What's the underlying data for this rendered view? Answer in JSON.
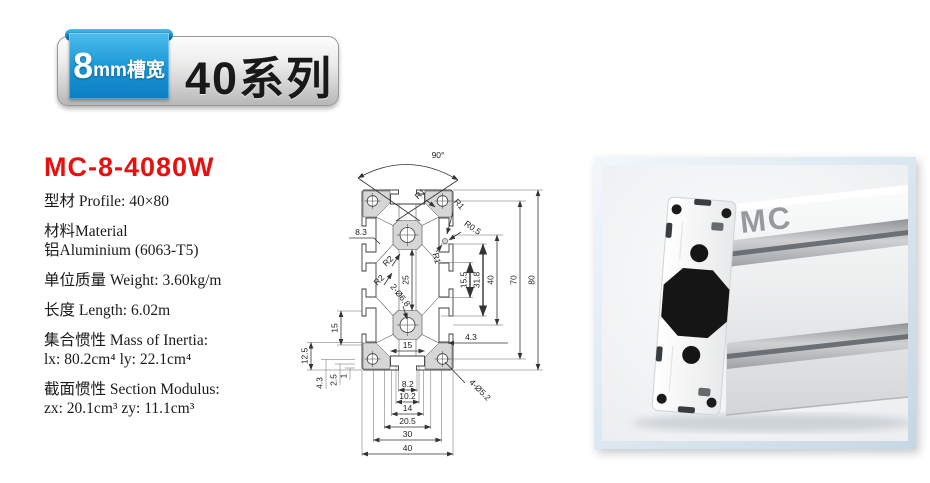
{
  "badge": {
    "slot_number": "8",
    "slot_unit": "mm槽宽",
    "series": "40系列",
    "ribbon_color": "#1b96d5"
  },
  "product": {
    "model": "MC-8-4080W",
    "accent_color": "#e8100e",
    "specs": [
      "型材 Profile: 40×80",
      "材料Material",
      "铝Aluminium (6063-T5)",
      "单位质量 Weight: 3.60kg/m",
      "长度 Length: 6.02m",
      "集合惯性 Mass of Inertia:",
      "lx: 80.2cm⁴   ly: 22.1cm⁴",
      "截面惯性 Section Modulus:",
      "zx: 20.1cm³  zy: 11.1cm³"
    ]
  },
  "drawing": {
    "labels": {
      "angle": "90°",
      "r1a": "R1",
      "r1b": "R1",
      "r05": "R0.5",
      "r1c": "R1",
      "r2a": "R2",
      "r2b": "R2",
      "dia2": "2-Ø6.8",
      "dia4": "4-Ø5.2",
      "d83": "8.3",
      "d25": "25",
      "d155": "15.5",
      "d318": "31.8",
      "d40r": "40",
      "d70": "70",
      "d80": "80",
      "d43r": "4.3",
      "d15m": "15",
      "d15l": "15",
      "d125": "12.5",
      "d43l": "4.3",
      "d25l": "2.5",
      "d1": "1",
      "d82": "8.2",
      "d102": "10.2",
      "d14": "14",
      "d205": "20.5",
      "d30": "30",
      "d40b": "40"
    }
  },
  "photo": {
    "brand_mark": "MC"
  }
}
